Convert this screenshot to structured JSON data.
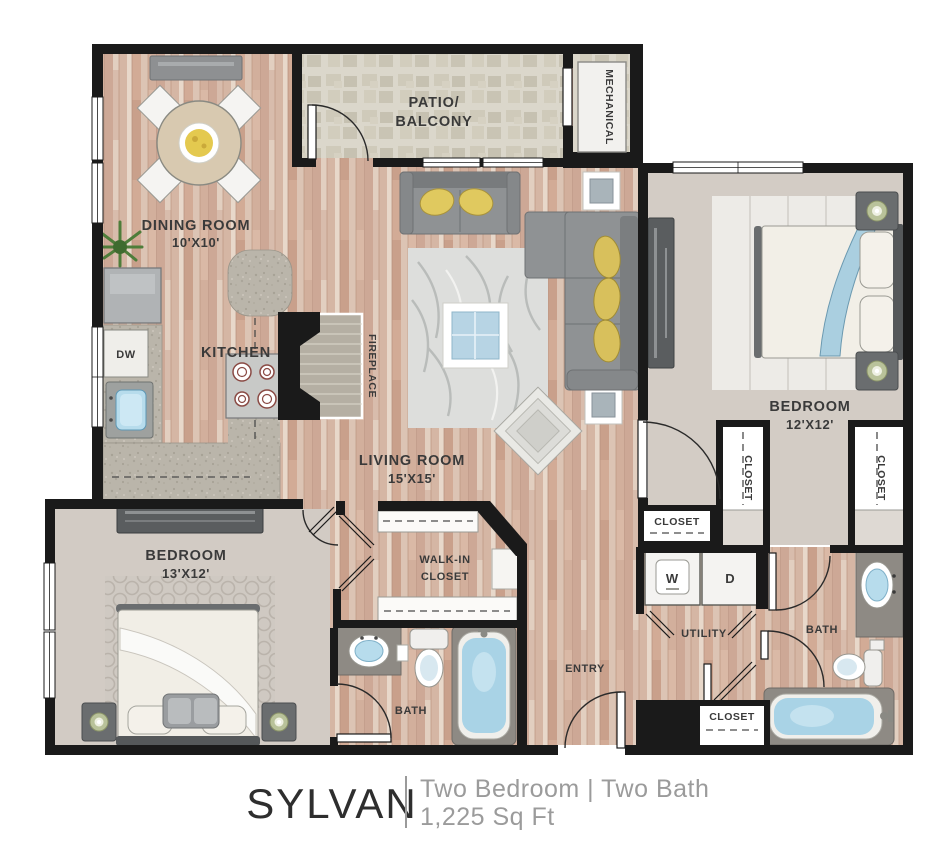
{
  "footer": {
    "name": "SYLVAN",
    "type": "Two Bedroom | Two Bath",
    "area": "1,225 Sq Ft"
  },
  "rooms": {
    "dining_room": {
      "label": "DINING ROOM",
      "dims": "10'X10'"
    },
    "kitchen": {
      "label": "KITCHEN"
    },
    "dishwasher": {
      "label": "DW"
    },
    "fireplace": {
      "label": "FIREPLACE"
    },
    "patio": {
      "line1": "PATIO/",
      "line2": "BALCONY"
    },
    "mechanical": {
      "label": "MECHANICAL"
    },
    "living_room": {
      "label": "LIVING ROOM",
      "dims": "15'X15'"
    },
    "bedroom_right": {
      "label": "BEDROOM",
      "dims": "12'X12'"
    },
    "bedroom_left": {
      "label": "BEDROOM",
      "dims": "13'X12'"
    },
    "walk_in_closet": {
      "line1": "WALK-IN",
      "line2": "CLOSET"
    },
    "bath_left": {
      "label": "BATH"
    },
    "bath_right": {
      "label": "BATH"
    },
    "utility": {
      "label": "UTILITY"
    },
    "entry": {
      "label": "ENTRY"
    },
    "washer": {
      "label": "W"
    },
    "dryer": {
      "label": "D"
    },
    "closet_hall": {
      "label": "CLOSET"
    },
    "closet_bedroom_right_left": {
      "label": "CLOSET"
    },
    "closet_bedroom_right_right": {
      "label": "CLOSET"
    },
    "closet_entry": {
      "label": "CLOSET"
    }
  },
  "colors": {
    "wall": "#1a1a1a",
    "wood_floor": "#d9c2b1",
    "carpet": "#d3ccc5",
    "patio_stone": "#dbd7cb",
    "counter_granite": "#bab5aa",
    "sofa_gray": "#8f9294",
    "pillow_yellow": "#e0c95f",
    "water_blue": "#a9d3e6",
    "label_text": "#3a3a3a",
    "footer_gray": "#9b9b9b"
  }
}
